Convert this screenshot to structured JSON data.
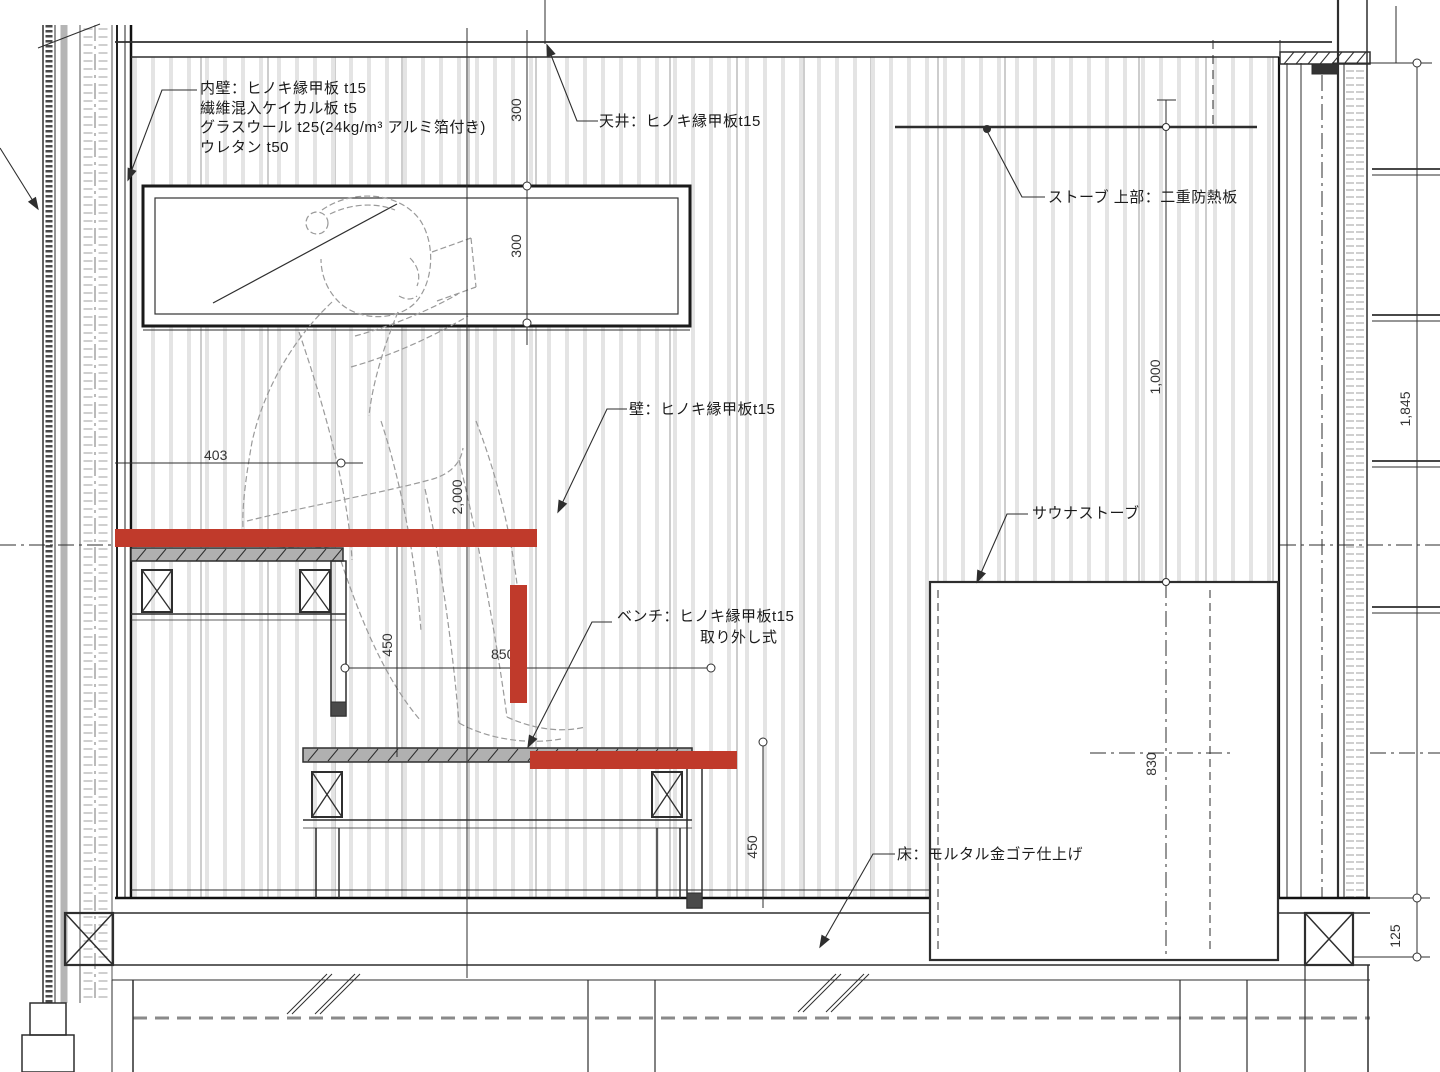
{
  "drawing": {
    "annotations": {
      "inner_wall_l1": "内壁：ヒノキ縁甲板 t15",
      "inner_wall_l2": "繊維混入ケイカル板 t5",
      "inner_wall_l3": "グラスウール t25(24kg/m³ アルミ箔付き)",
      "inner_wall_l4": "ウレタン t50",
      "ceiling": "天井：ヒノキ縁甲板t15",
      "stove_upper": "ストーブ 上部：二重防熱板",
      "wall": "壁：ヒノキ縁甲板t15",
      "bench_l1": "ベンチ：ヒノキ縁甲板t15",
      "bench_l2": "取り外し式",
      "sauna_stove": "サウナストーブ",
      "floor": "床：モルタル金ゴテ仕上げ"
    },
    "dimensions": {
      "ceiling_offset": "300",
      "window_height": "300",
      "room_height": "2,000",
      "bench_depth": "403",
      "bench_rise": "450",
      "bench_span": "850",
      "lower_bench_height": "450",
      "shield_to_stove": "1,000",
      "stove_height": "830",
      "wall_height": "1,845",
      "floor_depth": "125"
    },
    "colors": {
      "highlight_red": "#c03a2b",
      "line_dark": "#2e2e2e",
      "panel_stripe": "#e4e4e4"
    }
  }
}
